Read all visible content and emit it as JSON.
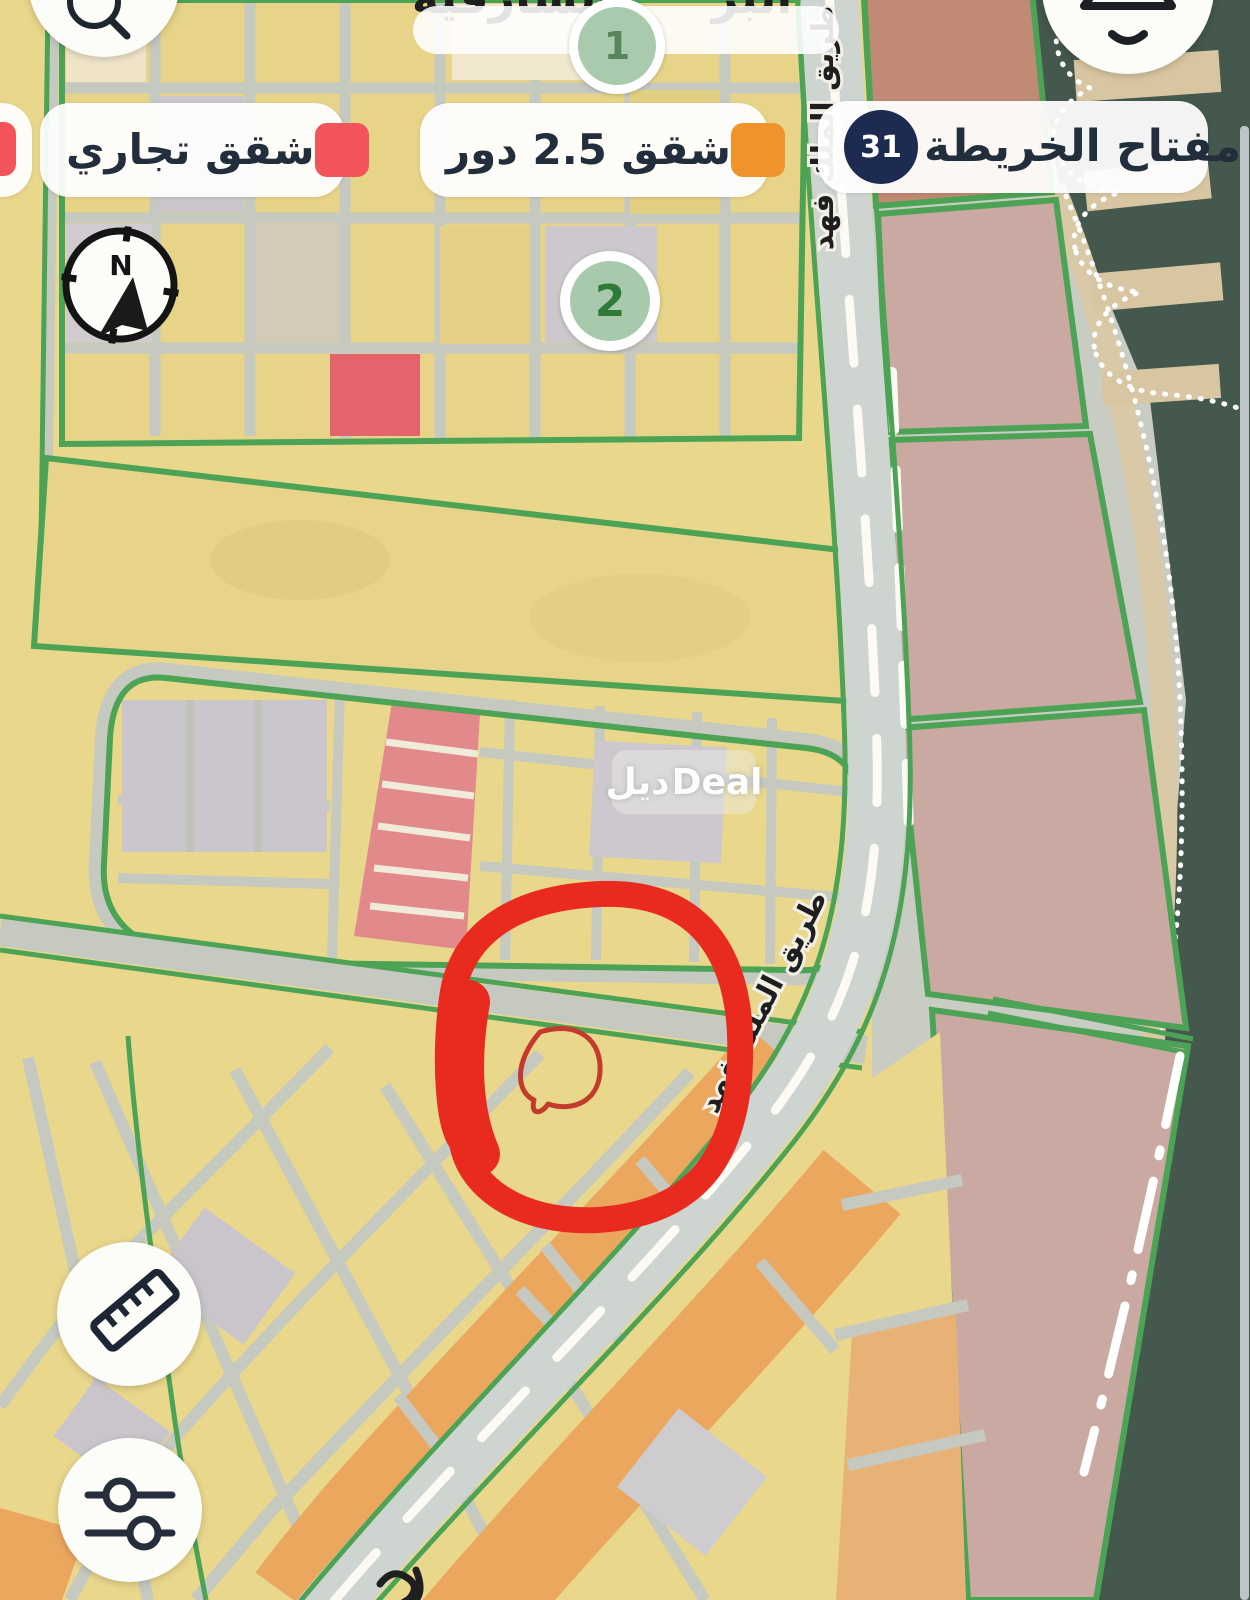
{
  "legend": {
    "title": "مفتاح الخريطة",
    "title_badge": "31",
    "items": [
      {
        "label": "شقق 2.5 دور",
        "color": "#f0932c"
      },
      {
        "label": "شقق تجاري",
        "color": "#f25459"
      },
      {
        "label": "",
        "color": "#f25459"
      }
    ]
  },
  "map": {
    "road_label": "طريق الملك فهد",
    "area_label_partial_1": "الشارقية",
    "area_label_partial_2": "البر",
    "marker_1": "1",
    "marker_2": "2",
    "compass_north": "N"
  },
  "watermark": {
    "arabic": "ديل",
    "latin": "Deal"
  },
  "icons": {
    "search": "magnifier",
    "top_right": "map-style",
    "compass": "north-needle",
    "ruler": "diagonal-ruler",
    "filters": "slider-knobs"
  },
  "colors": {
    "legend_red": "#f25459",
    "legend_orange": "#f0932c",
    "badge_navy": "#1d2b50",
    "boundary_green": "#4ca355",
    "annotation_red": "#e92a1f",
    "sea_teal": "#44584e",
    "parcel_yellow": "#e9d78c",
    "parcel_orange": "#eba75e",
    "parcel_mauve": "#c9a9a1",
    "marker_green": "#a9caac"
  }
}
